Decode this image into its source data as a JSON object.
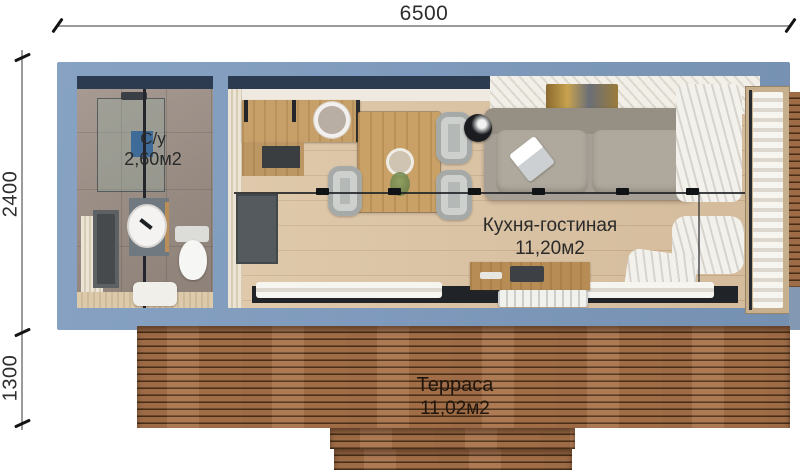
{
  "dimensions": {
    "width": "6500",
    "main_depth": "2400",
    "terrace_depth": "1300"
  },
  "rooms": {
    "bathroom": {
      "label": "С/у",
      "area": "2,60м2"
    },
    "kitchen_living": {
      "label": "Кухня-гостиная",
      "area": "11,20м2"
    },
    "terrace": {
      "label": "Терраса",
      "area": "11,02м2"
    }
  },
  "colors": {
    "wall_blue": "#7f9abc",
    "navy_header": "#2c3b50",
    "floor_wood": "#dcc3a2",
    "kitchen_wood": "#c79f68",
    "terrace_wood": "#a06b44",
    "sofa_gray": "#a59f95",
    "curtain_white": "#f4f2ed",
    "dimension_line": "#9b9b9b",
    "dimension_text": "#2d2d2d"
  }
}
